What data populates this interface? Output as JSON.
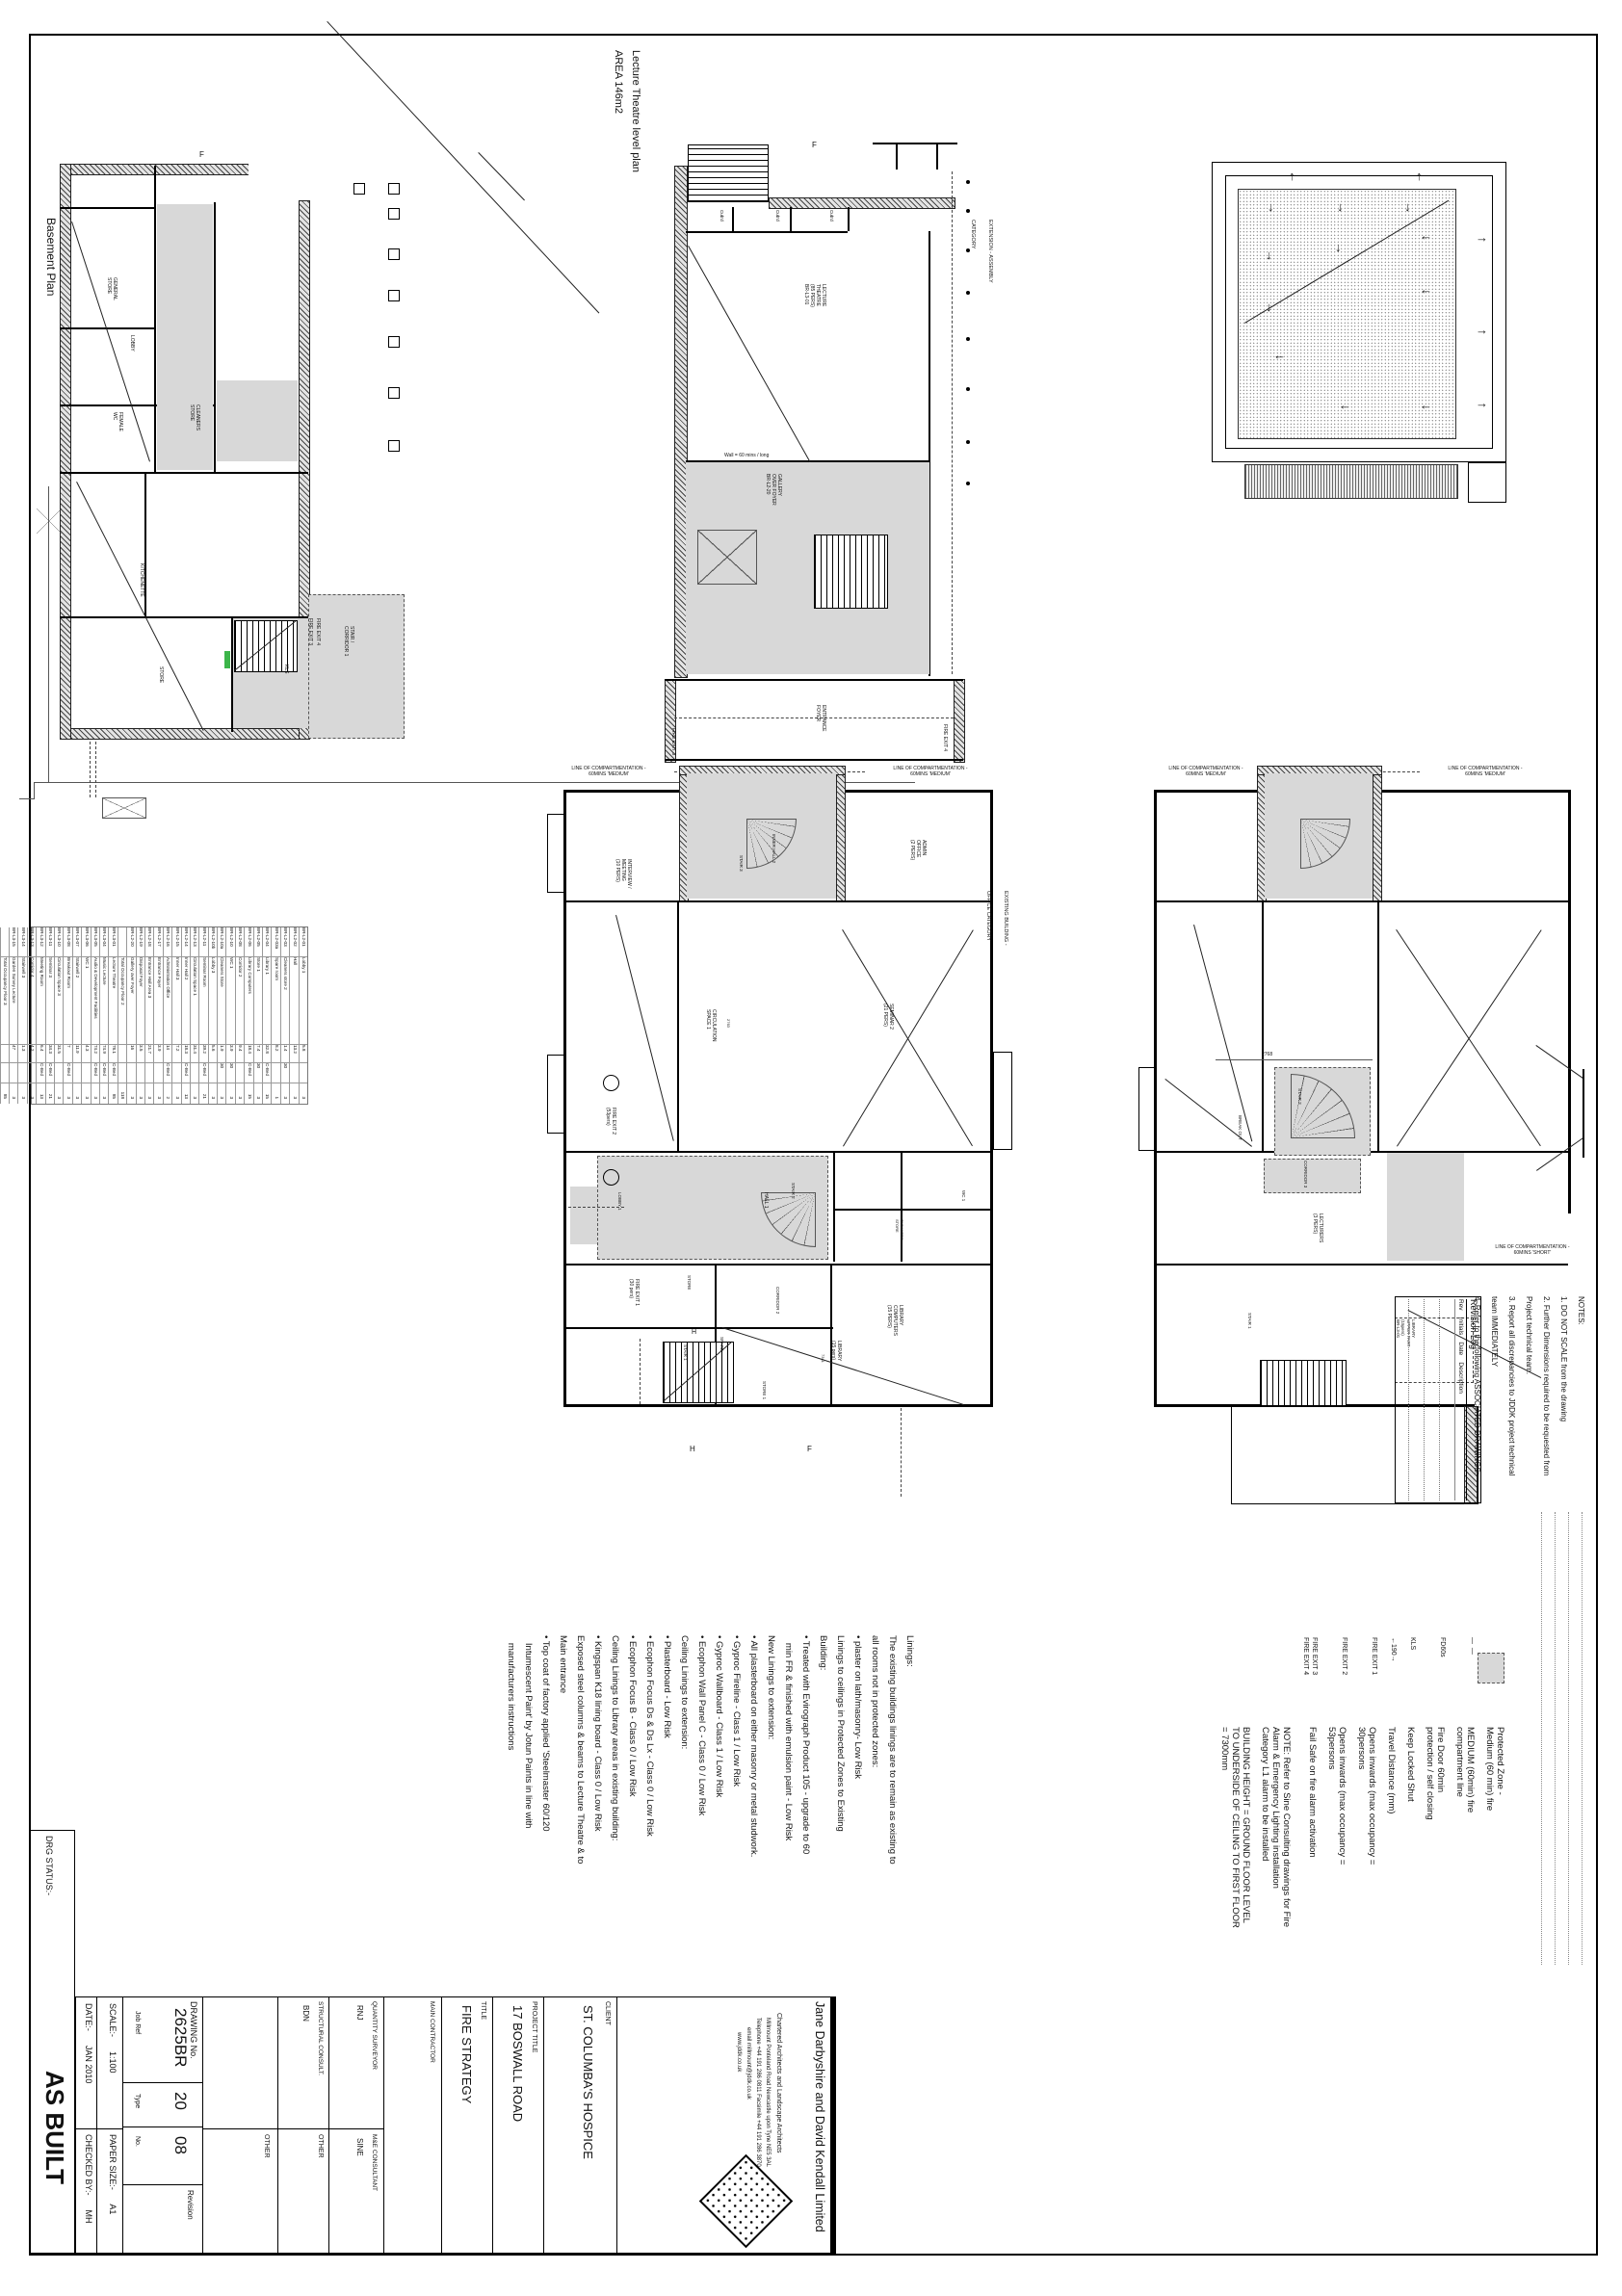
{
  "labels": {
    "basement_title": "Basement Plan",
    "lecture_title1": "Lecture Theatre level plan",
    "lecture_title2": "AREA 146m2"
  },
  "grid": {
    "f": "F",
    "h": "H"
  },
  "roof": {
    "up": "↑",
    "down": "↓",
    "left": "←",
    "right": "→"
  },
  "comp": {
    "medium": "LINE OF COMPARTMENTATION -\n60MINS 'MEDIUM'",
    "short": "LINE OF COMPARTMENTATION -\n60MINS 'SHORT'"
  },
  "basement": {
    "general_store": "GENERAL\nSTORE",
    "lobby": "LOBBY",
    "female_wc": "FEMALE\nWC",
    "cleaners": "CLEANERS\nSTORE",
    "kitchenette": "KITCHENETTE",
    "store": "STORE",
    "stair_corr": "STAIR /\nCORRIDOR 1",
    "kls": "KLS",
    "fe3": "FIRE EXIT 3",
    "fe4": "FIRE EXIT 4"
  },
  "lecture": {
    "theatre": "LECTURE\nTHEATRE\n(85 PERS)\nBR-L3-01",
    "cub": "Cub'd",
    "gallery": "GALLERY\nOVER FOYER\nBR-L2-20",
    "wall60": "Wall = 60 mins / long",
    "entrance": "ENTRANCE\nFOYER",
    "fe3": "FIRE EXIT 3",
    "fe4": "FIRE EXIT 4",
    "extension": "EXTENSION - ASSEMBLY\nCATEGORY"
  },
  "ground": {
    "interview": "INTERVIEW /\nMEETING\n(10 PERS)",
    "admin": "ADMIN\nOFFICE\n(2 PERS)",
    "inner_hall": "INNER HALL 2",
    "stair3": "STAIR 3",
    "circulation": "CIRCULATION\nSPACE 1",
    "seminar2": "SEMINAR 2\n(21 PERS)",
    "hall1": "HALL 1",
    "stair2": "STAIR 2",
    "lobby1": "LOBBY 1",
    "wc1": "WC 1",
    "cleaners": "CLEANERS\nSTORE",
    "store": "STORE",
    "corridor2": "CORRIDOR 2",
    "spare": "SPARE",
    "libcomp": "LIBRARY\nCOMPUTERS\n(15 PERS)",
    "library": "LIBRARY\n(15 pers)",
    "store1": "STORE 1",
    "stair1": "STAIR 1",
    "fe2": "FIRE EXIT 2\n(53pers)",
    "fe1": "FIRE EXIT 1\n(30 pers)",
    "existing": "EXISTING BUILDING -\nOFFICE CATEGORY",
    "d2763": "2763",
    "d7341": "7341"
  },
  "first": {
    "breakout": "BREAK OUT",
    "corridor3": "CORRIDOR 3",
    "lecturers": "LECTURERS\n(3 PERS)",
    "stair2": "STAIR 2",
    "stair1": "STAIR 1",
    "library_upper": "LIBRARY\nUPPER PART\n(15pers)\nBR-L3-01",
    "d2768": "2768"
  },
  "linings": "Linings:\nThe existing buildings linings are to remain as existing to\nall rooms not in protected zones:\n• plaster on lath/masonry- Low Risk\nLinings to ceilings in Protected Zones to Existing\nBuilding:\n• Treated with Evirograph Product 105 - upgrade to 60\n   min FR & finished with emulsion paint - Low Risk\nNew Linings to extension:\n• All plasterboard on either masonry or metal studwork.\n• Gyproc Fireline - Class 1 / Low Risk\n• Gyproc Wallboard - Class 1 / Low Risk\n• Ecophon Wall Panel C - Class 0 / Low Risk\nCeiling Linings to extension:\n• Plasterboard - Low Risk\n• Ecophon Focus Ds & Ds Lx - Class 0 / Low Risk\n• Ecophon Focus B - Class 0 / Low Risk\nCeiling Linings to Library areas in existing building:\n• Kingspan K18 lining board - Class 0 / Low Risk\nExposed steel columns & beams to Lecture Theatre & to\nMain entrance\n• Top coat of factory applied 'Steelmaster 60/120\n   Intumescent Paint' by Jotun Paints in line with\n   manufacturers instructions",
  "legend": {
    "items": [
      {
        "sym": "",
        "text": "Protected Zone -\nMedium (60 min) fire"
      },
      {
        "sym": "—  —",
        "text": "MEDIUM (60min) fire\ncompartment line"
      },
      {
        "sym": "FD60s",
        "text": "Fire Door 60min\nprotection / self closing"
      },
      {
        "sym": "KLS",
        "text": "Keep Locked Shut"
      },
      {
        "sym": "←190→",
        "text": "Travel Distance (mm)"
      },
      {
        "sym": "FIRE EXIT 1",
        "text": "Opens inwards (max occupancy =\n30persons"
      },
      {
        "sym": "FIRE EXIT 2",
        "text": "Opens inwards (max occupancy =\n53persons"
      },
      {
        "sym": "FIRE EXIT 3\nFIRE EXIT 4",
        "text": "Fail Safe on fire alarm activation"
      },
      {
        "sym": "",
        "text": "NOTE: Refer to Sine Consulting drawings for Fire\nAlarm & Emergency Lighting installation\nCategory L1 alarm to be installed"
      },
      {
        "sym": "",
        "text": "BUILDING HEIGHT = GROUND FLOOR LEVEL\nTO UNDERSIDE OF CEILING TO FIRST FLOOR\n= 7300mm"
      }
    ]
  },
  "notes": "NOTES:\n1. DO NOT SCALE from the drawing\n2. Further Dimensions required to be requested from\nProject technical team.\n3. Report all discrepancies to JDDK project technical\nteam IMMEDIATELY\n4. Refer to the following ASSOCIATED DRAWINGS:-",
  "revision": {
    "title": "Revision Log",
    "headers": "Rev    Initials    Date    Description"
  },
  "table": {
    "rows": [
      [
        "BR-L2-01",
        "Lobby 1",
        "5.8",
        "",
        "3"
      ],
      [
        "BR-L2-02",
        "Hall",
        "13.2",
        "",
        "3"
      ],
      [
        "BR-L2-03",
        "Cleaners store 2",
        "1.4",
        "30",
        "3"
      ],
      [
        "BR-L2-03a",
        "Spare room",
        "8.2",
        "",
        "1"
      ],
      [
        "BR-L2-04",
        "Library 1",
        "32.8",
        "C-Bed",
        "15"
      ],
      [
        "BR-L2-05",
        "Store 1",
        "7.4",
        "30",
        "3"
      ],
      [
        "BR-L2-06",
        "Library Computers",
        "18.4",
        "C-Bed",
        "15"
      ],
      [
        "BR-L2-08",
        "Corridor 2",
        "9.4",
        "",
        "3"
      ],
      [
        "BR-L2-10",
        "WC 1",
        "3.9",
        "30",
        "3"
      ],
      [
        "BR-L2-10a",
        "Cleaners Store",
        "1.9",
        "30",
        "3"
      ],
      [
        "BR-L2-10b",
        "Lobby 3",
        "5.6",
        "",
        "3"
      ],
      [
        "BR-L2-11",
        "Seminar Room",
        "39.2",
        "C-Bed",
        "21"
      ],
      [
        "BR-L2-13",
        "Circulation Space 1",
        "31.4",
        "",
        "3"
      ],
      [
        "BR-L2-14",
        "Inner Hall 2",
        "18.3",
        "C-Bed",
        "13"
      ],
      [
        "BR-L2-15",
        "Inner Hall 3",
        "7.2",
        "",
        "3"
      ],
      [
        "BR-L2-16",
        "Administration Office",
        "14",
        "C-Bed",
        "2"
      ],
      [
        "BR-L2-17",
        "Entrance Foyer",
        "3.9",
        "",
        "3"
      ],
      [
        "BR-L2-18",
        "Entrance Hall Area 3",
        "21.7",
        "",
        "3"
      ],
      [
        "BR-L2-19",
        "Disposal Foyer",
        "3.5",
        "",
        "3"
      ],
      [
        "BR-L2-20",
        "Gallery over Foyer",
        "16",
        "",
        "3"
      ],
      [
        "",
        "Total Occupancy Floor 2",
        "",
        "",
        "118"
      ],
      [
        "BR-L3-01",
        "Lecture Theatre",
        "78.1",
        "C-Bed",
        "85"
      ],
      [
        "BR-L3-04",
        "Music Lecture",
        "74.9",
        "C-Bed",
        "3"
      ],
      [
        "BR-L3-05",
        "Audio & Development Facilities",
        "74.2",
        "C-Bed",
        "3"
      ],
      [
        "BR-L3-06",
        "WC 1",
        "4.3",
        "",
        "3"
      ],
      [
        "BR-L3-07",
        "Stairwell 2",
        "11.9",
        "",
        "3"
      ],
      [
        "BR-L3-08",
        "Breakout Room",
        "7",
        "C-Bed",
        "3"
      ],
      [
        "BR-L3-10",
        "Circulation Space 3",
        "31.5",
        "",
        "3"
      ],
      [
        "BR-L3-11",
        "Seminar 3",
        "34.3",
        "C-Bed",
        "21"
      ],
      [
        "BR-L3-12",
        "Meeting Room",
        "6.4",
        "C-Bed",
        "13"
      ],
      [
        "BR-L3-13",
        "Corridor 4",
        "4.2",
        "",
        "3"
      ],
      [
        "BR-L3-14",
        "Stairwell 3",
        "1.3",
        "",
        "3"
      ],
      [
        "BR-L3-15",
        "Garden Survey Lecture",
        "47",
        "",
        "3"
      ],
      [
        "",
        "Total Occupancy Floor 3",
        "",
        "",
        "85"
      ]
    ]
  },
  "titleblock": {
    "drg_status_label": "DRG STATUS:-",
    "drg_status": "AS BUILT",
    "date": "DATE:-      JAN 2010",
    "checked": "CHECKED BY:-      MH",
    "scale": "SCALE:-      1:100",
    "paper": "PAPER SIZE:-      A1",
    "drawing_no_label": "DRAWING No.",
    "job_ref": "2625BR",
    "type_no": "20",
    "no": "08",
    "job_ref_label": "Job Ref",
    "type_label": "Type",
    "no_label": "No.",
    "revision_label": "Revision",
    "other": "OTHER",
    "struct_label": "STRUCTURAL CONSULT.",
    "struct": "BDN",
    "qs_label": "QUANTITY SURVEYOR",
    "qs": "RNJ",
    "me_label": "M&E CONSULTANT",
    "me": "SINE",
    "main_contractor_label": "MAIN CONTRACTOR",
    "title_label": "TITLE",
    "title": "FIRE STRATEGY",
    "project_label": "PROJECT TITLE",
    "project": "17 BOSWALL ROAD",
    "client_label": "CLIENT",
    "client": "ST. COLUMBA'S HOSPICE"
  },
  "firm": {
    "name": "Jane Darbyshire and David Kendall Limited",
    "line2": "Chartered Architects and Landscape Architects",
    "line3": "Millmount Ponteland Road Newcastle upon Tyne NE5 3AL",
    "line4": "Telephone +44 191 286 0811 Facsimile +44 191 286 3870",
    "line5": "email millmount@jddk.co.uk",
    "line6": "www.jddk.co.uk"
  }
}
